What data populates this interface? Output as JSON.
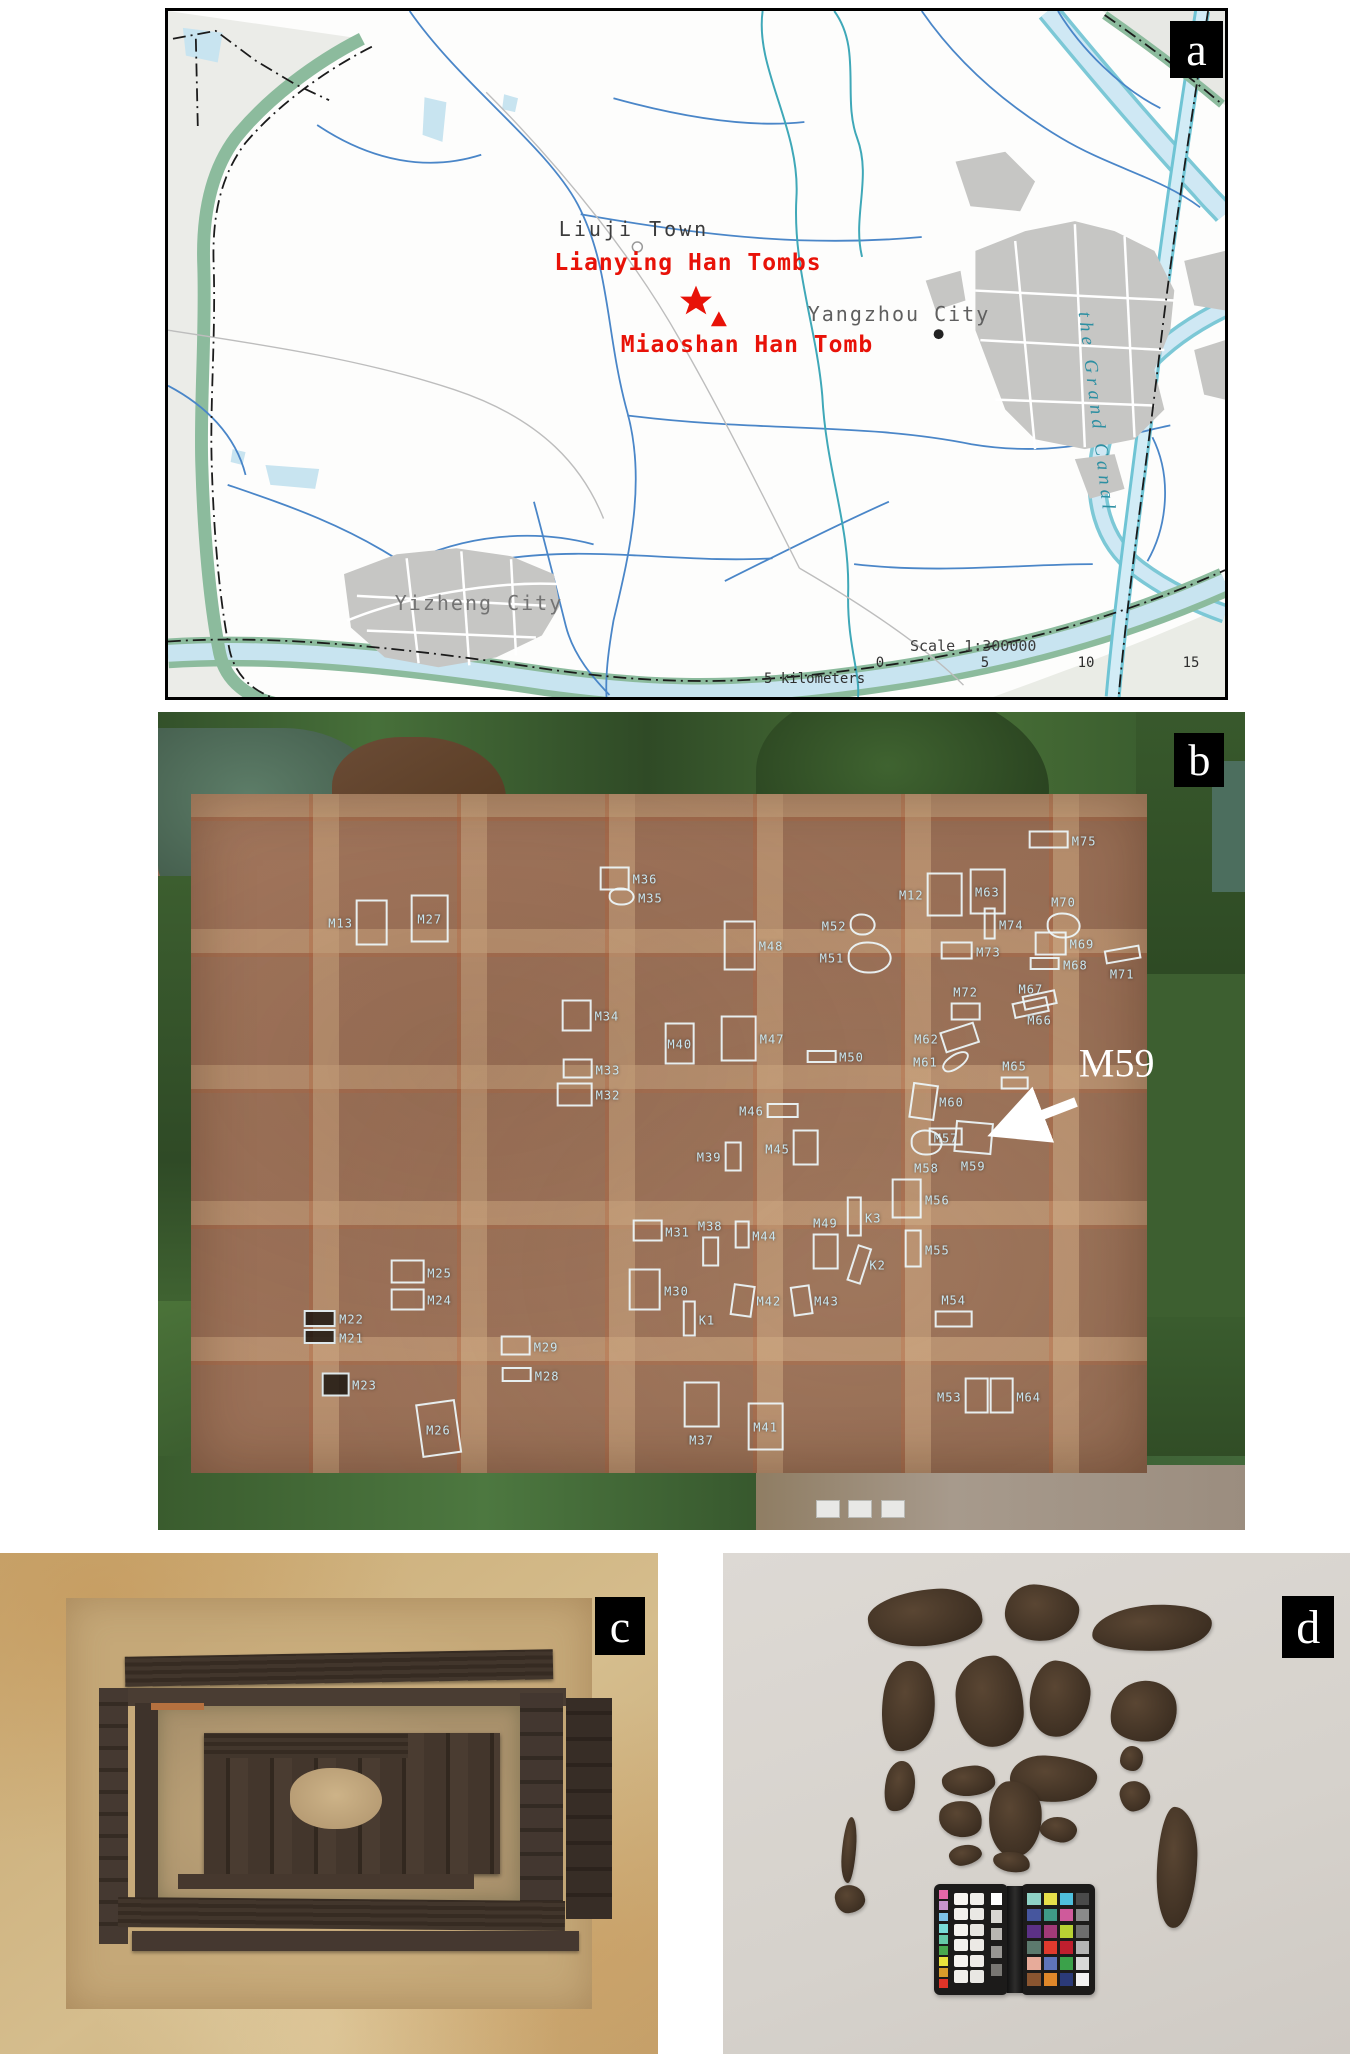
{
  "panel_labels": {
    "a": "a",
    "b": "b",
    "c": "c",
    "d": "d"
  },
  "map": {
    "town": "Liuji Town",
    "lianying": "Lianying Han Tombs",
    "miaoshan": "Miaoshan Han Tomb",
    "yangzhou": "Yangzhou City",
    "yizheng": "Yizheng City",
    "canal": "the Grand Canal",
    "scale_label": "Scale 1:300000",
    "scale_unit": "5 kilometers",
    "ticks": [
      "0",
      "5",
      "10",
      "15"
    ],
    "tick_px": [
      712,
      817,
      918,
      1023
    ],
    "colors": {
      "site_red": "#e81208",
      "canal_text": "#2d8fa2",
      "water": "#cfe8f4",
      "urban": "#c6c6c4",
      "green_band": "#8cbb9d"
    }
  },
  "site": {
    "callout": "M59",
    "labels": [
      {
        "id": "M13",
        "x": 16.8,
        "y": 25.7,
        "side": "right",
        "w": 32,
        "h": 46
      },
      {
        "id": "M27",
        "x": 25.0,
        "y": 25.2,
        "side": "inside",
        "w": 38,
        "h": 48
      },
      {
        "id": "M36",
        "x": 44.8,
        "y": 20.3,
        "side": "left",
        "w": 30,
        "h": 24
      },
      {
        "id": "M35",
        "x": 45.3,
        "y": 22.6,
        "side": "left",
        "w": 26,
        "h": 18,
        "shape": "blob"
      },
      {
        "id": "M75",
        "x": 85.2,
        "y": 15.6,
        "side": "left",
        "w": 40,
        "h": 18
      },
      {
        "id": "M12",
        "x": 69.3,
        "y": 22.3,
        "side": "right",
        "w": 36,
        "h": 44
      },
      {
        "id": "M63",
        "x": 76.3,
        "y": 21.9,
        "side": "inside",
        "w": 36,
        "h": 46
      },
      {
        "id": "M70",
        "x": 83.3,
        "y": 23.1,
        "side": "below",
        "w": 34,
        "h": 26,
        "shape": "blob"
      },
      {
        "id": "M74",
        "x": 78.5,
        "y": 25.9,
        "side": "left",
        "w": 12,
        "h": 32
      },
      {
        "id": "M73",
        "x": 76.4,
        "y": 29.2,
        "side": "left",
        "w": 32,
        "h": 18
      },
      {
        "id": "M69",
        "x": 85.0,
        "y": 28.3,
        "side": "left",
        "w": 32,
        "h": 24
      },
      {
        "id": "M68",
        "x": 84.4,
        "y": 30.8,
        "side": "left",
        "w": 30,
        "h": 13
      },
      {
        "id": "M71",
        "x": 88.7,
        "y": 31.9,
        "side": "above",
        "w": 36,
        "h": 14,
        "rot": -10
      },
      {
        "id": "M52",
        "x": 62.2,
        "y": 26.0,
        "side": "right",
        "w": 26,
        "h": 22,
        "shape": "blob"
      },
      {
        "id": "M48",
        "x": 56.4,
        "y": 28.5,
        "side": "left",
        "w": 32,
        "h": 50
      },
      {
        "id": "M51",
        "x": 62.0,
        "y": 30.0,
        "side": "right",
        "w": 44,
        "h": 32,
        "shape": "blob"
      },
      {
        "id": "M72",
        "x": 74.3,
        "y": 34.1,
        "side": "below",
        "w": 30,
        "h": 18
      },
      {
        "id": "M67",
        "x": 80.3,
        "y": 33.8,
        "side": "below",
        "w": 36,
        "h": 16,
        "rot": -12
      },
      {
        "id": "M66",
        "x": 81.1,
        "y": 37.5,
        "side": "above",
        "w": 34,
        "h": 15,
        "rot": -12
      },
      {
        "id": "M34",
        "x": 41.3,
        "y": 37.1,
        "side": "left",
        "w": 30,
        "h": 32
      },
      {
        "id": "M40",
        "x": 48.0,
        "y": 40.5,
        "side": "inside",
        "w": 30,
        "h": 42
      },
      {
        "id": "M47",
        "x": 56.5,
        "y": 39.9,
        "side": "left",
        "w": 36,
        "h": 46
      },
      {
        "id": "M50",
        "x": 63.8,
        "y": 42.1,
        "side": "left",
        "w": 30,
        "h": 13
      },
      {
        "id": "M62",
        "x": 70.7,
        "y": 39.8,
        "side": "right",
        "w": 36,
        "h": 22,
        "rot": -18
      },
      {
        "id": "M61",
        "x": 70.6,
        "y": 42.7,
        "side": "right",
        "w": 30,
        "h": 15,
        "rot": -35,
        "shape": "blob"
      },
      {
        "id": "M65",
        "x": 78.8,
        "y": 43.1,
        "side": "below",
        "w": 28,
        "h": 13
      },
      {
        "id": "M33",
        "x": 41.4,
        "y": 43.6,
        "side": "left",
        "w": 30,
        "h": 20
      },
      {
        "id": "M32",
        "x": 41.4,
        "y": 46.7,
        "side": "left",
        "w": 36,
        "h": 24
      },
      {
        "id": "M46",
        "x": 54.6,
        "y": 48.7,
        "side": "right",
        "w": 32,
        "h": 15
      },
      {
        "id": "M60",
        "x": 73.0,
        "y": 47.6,
        "side": "left",
        "w": 26,
        "h": 36,
        "rot": 8
      },
      {
        "id": "M39",
        "x": 50.7,
        "y": 54.3,
        "side": "right",
        "w": 17,
        "h": 30
      },
      {
        "id": "M45",
        "x": 57.0,
        "y": 53.3,
        "side": "right",
        "w": 26,
        "h": 36
      },
      {
        "id": "M57",
        "x": 72.5,
        "y": 51.9,
        "side": "inside",
        "w": 34,
        "h": 18
      },
      {
        "id": "M58",
        "x": 70.7,
        "y": 55.6,
        "side": "above",
        "w": 32,
        "h": 26,
        "shape": "blob"
      },
      {
        "id": "M59",
        "x": 75.0,
        "y": 55.4,
        "side": "above",
        "w": 38,
        "h": 32,
        "rot": 5
      },
      {
        "id": "M56",
        "x": 71.7,
        "y": 59.5,
        "side": "left",
        "w": 30,
        "h": 40
      },
      {
        "id": "M31",
        "x": 47.8,
        "y": 63.4,
        "side": "left",
        "w": 30,
        "h": 22
      },
      {
        "id": "M38",
        "x": 50.8,
        "y": 62.7,
        "side": "below",
        "w": 17,
        "h": 30
      },
      {
        "id": "M44",
        "x": 55.8,
        "y": 63.9,
        "side": "left",
        "w": 15,
        "h": 28
      },
      {
        "id": "M49",
        "x": 61.4,
        "y": 62.3,
        "side": "below",
        "w": 26,
        "h": 36
      },
      {
        "id": "K3",
        "x": 65.8,
        "y": 61.7,
        "side": "left",
        "w": 15,
        "h": 40
      },
      {
        "id": "K2",
        "x": 66.2,
        "y": 67.5,
        "side": "left",
        "w": 15,
        "h": 38,
        "rot": 18
      },
      {
        "id": "M55",
        "x": 71.7,
        "y": 65.6,
        "side": "left",
        "w": 17,
        "h": 38
      },
      {
        "id": "M54",
        "x": 73.2,
        "y": 71.7,
        "side": "below",
        "w": 38,
        "h": 17
      },
      {
        "id": "M25",
        "x": 25.9,
        "y": 68.4,
        "side": "left",
        "w": 34,
        "h": 24
      },
      {
        "id": "M24",
        "x": 25.9,
        "y": 71.8,
        "side": "left",
        "w": 34,
        "h": 22
      },
      {
        "id": "M22",
        "x": 17.8,
        "y": 74.1,
        "side": "left",
        "w": 32,
        "h": 17,
        "fill": "dark"
      },
      {
        "id": "M21",
        "x": 17.8,
        "y": 76.4,
        "side": "left",
        "w": 32,
        "h": 15,
        "fill": "dark"
      },
      {
        "id": "M23",
        "x": 19.0,
        "y": 82.2,
        "side": "left",
        "w": 28,
        "h": 24,
        "fill": "dark"
      },
      {
        "id": "M29",
        "x": 35.7,
        "y": 77.5,
        "side": "left",
        "w": 30,
        "h": 20
      },
      {
        "id": "M28",
        "x": 35.8,
        "y": 81.0,
        "side": "left",
        "w": 30,
        "h": 15
      },
      {
        "id": "M26",
        "x": 25.8,
        "y": 87.6,
        "side": "inside",
        "w": 40,
        "h": 54,
        "rot": -8
      },
      {
        "id": "M30",
        "x": 47.7,
        "y": 70.6,
        "side": "left",
        "w": 32,
        "h": 42
      },
      {
        "id": "K1",
        "x": 50.5,
        "y": 74.2,
        "side": "left",
        "w": 13,
        "h": 36
      },
      {
        "id": "M42",
        "x": 56.2,
        "y": 71.9,
        "side": "left",
        "w": 22,
        "h": 32,
        "rot": 8
      },
      {
        "id": "M43",
        "x": 61.5,
        "y": 71.9,
        "side": "left",
        "w": 20,
        "h": 30,
        "rot": -8
      },
      {
        "id": "M37",
        "x": 50.0,
        "y": 88.9,
        "side": "above",
        "w": 36,
        "h": 46
      },
      {
        "id": "M41",
        "x": 55.9,
        "y": 87.3,
        "side": "inside",
        "w": 36,
        "h": 48
      },
      {
        "id": "M53",
        "x": 72.8,
        "y": 83.6,
        "side": "right",
        "w": 24,
        "h": 36
      },
      {
        "id": "M64",
        "x": 80.1,
        "y": 83.6,
        "side": "left",
        "w": 24,
        "h": 36
      }
    ]
  },
  "fragments": [
    {
      "x": 23.1,
      "y": 7.4,
      "w": 18.2,
      "h": 11.1,
      "rot": -6
    },
    {
      "x": 44.9,
      "y": 6.3,
      "w": 11.8,
      "h": 11.1,
      "rot": 4
    },
    {
      "x": 58.8,
      "y": 10.4,
      "w": 19.2,
      "h": 9.1,
      "rot": -3
    },
    {
      "x": 25.4,
      "y": 21.5,
      "w": 8.5,
      "h": 18.1,
      "rot": 8
    },
    {
      "x": 37.1,
      "y": 20.5,
      "w": 10.7,
      "h": 18.1,
      "rot": -4
    },
    {
      "x": 48.9,
      "y": 21.5,
      "w": 9.6,
      "h": 15.1,
      "rot": 5
    },
    {
      "x": 61.7,
      "y": 25.5,
      "w": 10.7,
      "h": 12.1,
      "rot": -7
    },
    {
      "x": 25.9,
      "y": 41.6,
      "w": 4.8,
      "h": 10.1,
      "rot": 12
    },
    {
      "x": 35.0,
      "y": 42.6,
      "w": 8.5,
      "h": 6.0,
      "rot": -5
    },
    {
      "x": 45.7,
      "y": 40.6,
      "w": 13.9,
      "h": 9.1,
      "rot": 3
    },
    {
      "x": 63.3,
      "y": 38.6,
      "w": 3.7,
      "h": 5.0,
      "rot": 0
    },
    {
      "x": 63.3,
      "y": 45.6,
      "w": 4.8,
      "h": 6.0,
      "rot": -10
    },
    {
      "x": 34.4,
      "y": 49.6,
      "w": 6.9,
      "h": 7.1,
      "rot": 6
    },
    {
      "x": 42.5,
      "y": 45.6,
      "w": 8.5,
      "h": 15.1,
      "rot": -3
    },
    {
      "x": 50.5,
      "y": 52.7,
      "w": 5.9,
      "h": 5.0,
      "rot": 9
    },
    {
      "x": 36.0,
      "y": 58.2,
      "w": 5.3,
      "h": 4.0,
      "rot": -12
    },
    {
      "x": 43.0,
      "y": 59.7,
      "w": 5.9,
      "h": 4.0,
      "rot": 7
    },
    {
      "x": 69.2,
      "y": 50.7,
      "w": 6.4,
      "h": 24.1,
      "rot": 2
    },
    {
      "x": 18.9,
      "y": 52.7,
      "w": 2.2,
      "h": 13.1,
      "rot": 4
    },
    {
      "x": 17.8,
      "y": 66.2,
      "w": 4.8,
      "h": 5.5,
      "rot": -6
    }
  ],
  "card": {
    "left_strip": [
      "#e668a8",
      "#c693cc",
      "#7ec3e8",
      "#7adcd8",
      "#66c9a8",
      "#49a84f",
      "#e8e23c",
      "#d89c2a",
      "#e03428"
    ],
    "neutrals": [
      "#f7f5f1",
      "#efede9",
      "#f2f0ec",
      "#eae8e4",
      "#f5f3ef",
      "#e7e5e1",
      "#f3f1ed",
      "#ece9e5",
      "#f6f4f0",
      "#eeebe7",
      "#f1efeb",
      "#e9e7e3"
    ],
    "grays": [
      "#ffffff",
      "#d8d6d2",
      "#b8b6b2",
      "#989692",
      "#787672"
    ],
    "right_grid": [
      [
        "#8ed2c6",
        "#e6df4a",
        "#4fc0dd",
        "#4a4a4a"
      ],
      [
        "#46569e",
        "#3f9a87",
        "#cf5a9b",
        "#8a8a8a"
      ],
      [
        "#5c3186",
        "#a23a78",
        "#b8d133",
        "#6e6e6e"
      ],
      [
        "#5c7a6e",
        "#e03a2e",
        "#c01f2e",
        "#b5b5b5"
      ],
      [
        "#e7ab9a",
        "#5f74bb",
        "#3ba14a",
        "#d8d8d8"
      ],
      [
        "#8a5530",
        "#e0882a",
        "#2b3a78",
        "#f2f2f2"
      ]
    ]
  }
}
